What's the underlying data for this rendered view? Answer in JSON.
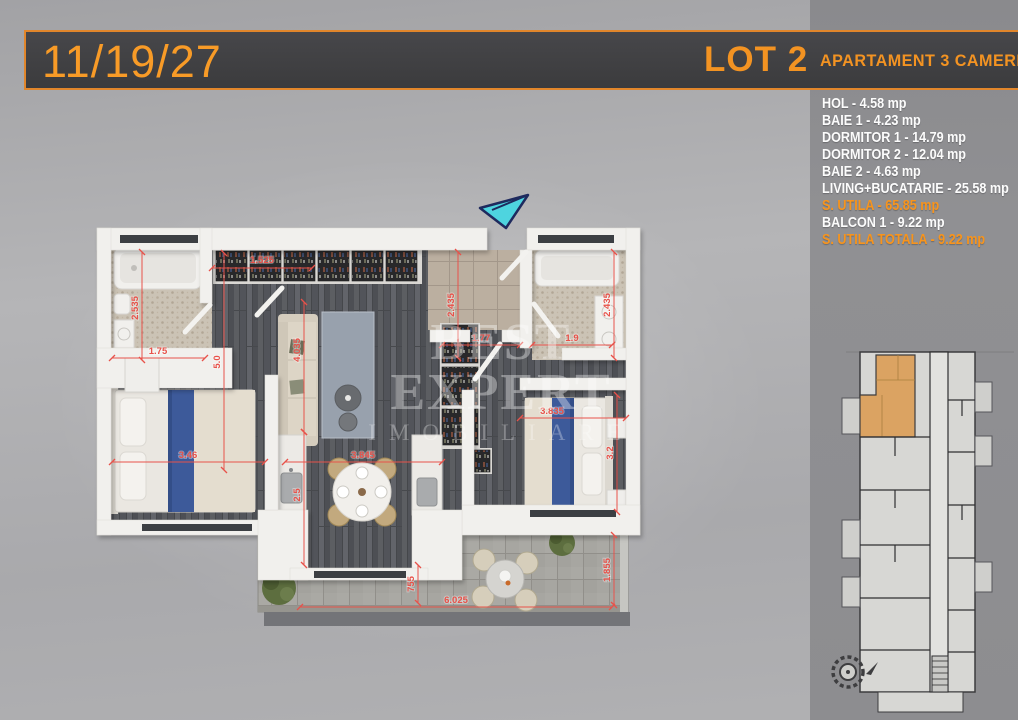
{
  "header": {
    "unit_number": "11/19/27",
    "lot_label": "LOT 2",
    "apartment_type": "APARTAMENT 3 CAMERE"
  },
  "room_list": [
    {
      "text": "HOL - 4.58 mp",
      "highlight": false
    },
    {
      "text": "BAIE 1 - 4.23 mp",
      "highlight": false
    },
    {
      "text": "DORMITOR 1 - 14.79 mp",
      "highlight": false
    },
    {
      "text": "DORMITOR 2 - 12.04 mp",
      "highlight": false
    },
    {
      "text": "BAIE 2 - 4.63 mp",
      "highlight": false
    },
    {
      "text": "LIVING+BUCATARIE - 25.58 mp",
      "highlight": false
    },
    {
      "text": "S. UTILA - 65.85 mp",
      "highlight": true
    },
    {
      "text": "BALCON 1 - 9.22 mp",
      "highlight": false
    },
    {
      "text": "S. UTILA TOTALA - 9.22 mp",
      "highlight": true
    }
  ],
  "watermark": {
    "line1": "BEST EXPERT",
    "line2": "IMOBILIARE"
  },
  "plan": {
    "dimensions": {
      "bath1_height": "2.535",
      "bath1_width": "1.75",
      "closet_width": "1.525",
      "hall_left_height": "5.0",
      "living_height": "4.035",
      "kitchen_height": "2.5",
      "hol_height": "2.435",
      "hol_width": "1.77",
      "bath2_width": "1.9",
      "bath2_height": "2.435",
      "bedroom2_width": "3.835",
      "bedroom2_height": "3.2",
      "bedroom1_width": "3.46",
      "living_width": "3.845",
      "balcony_step": "755",
      "balcony_width": "6.025",
      "balcony_height": "1.855"
    }
  },
  "colors": {
    "accent_orange": "#f7941d",
    "dimension_red": "#e8524a",
    "highlighted_unit": "#dba362",
    "entrance_arrow": "#4ed4df"
  }
}
